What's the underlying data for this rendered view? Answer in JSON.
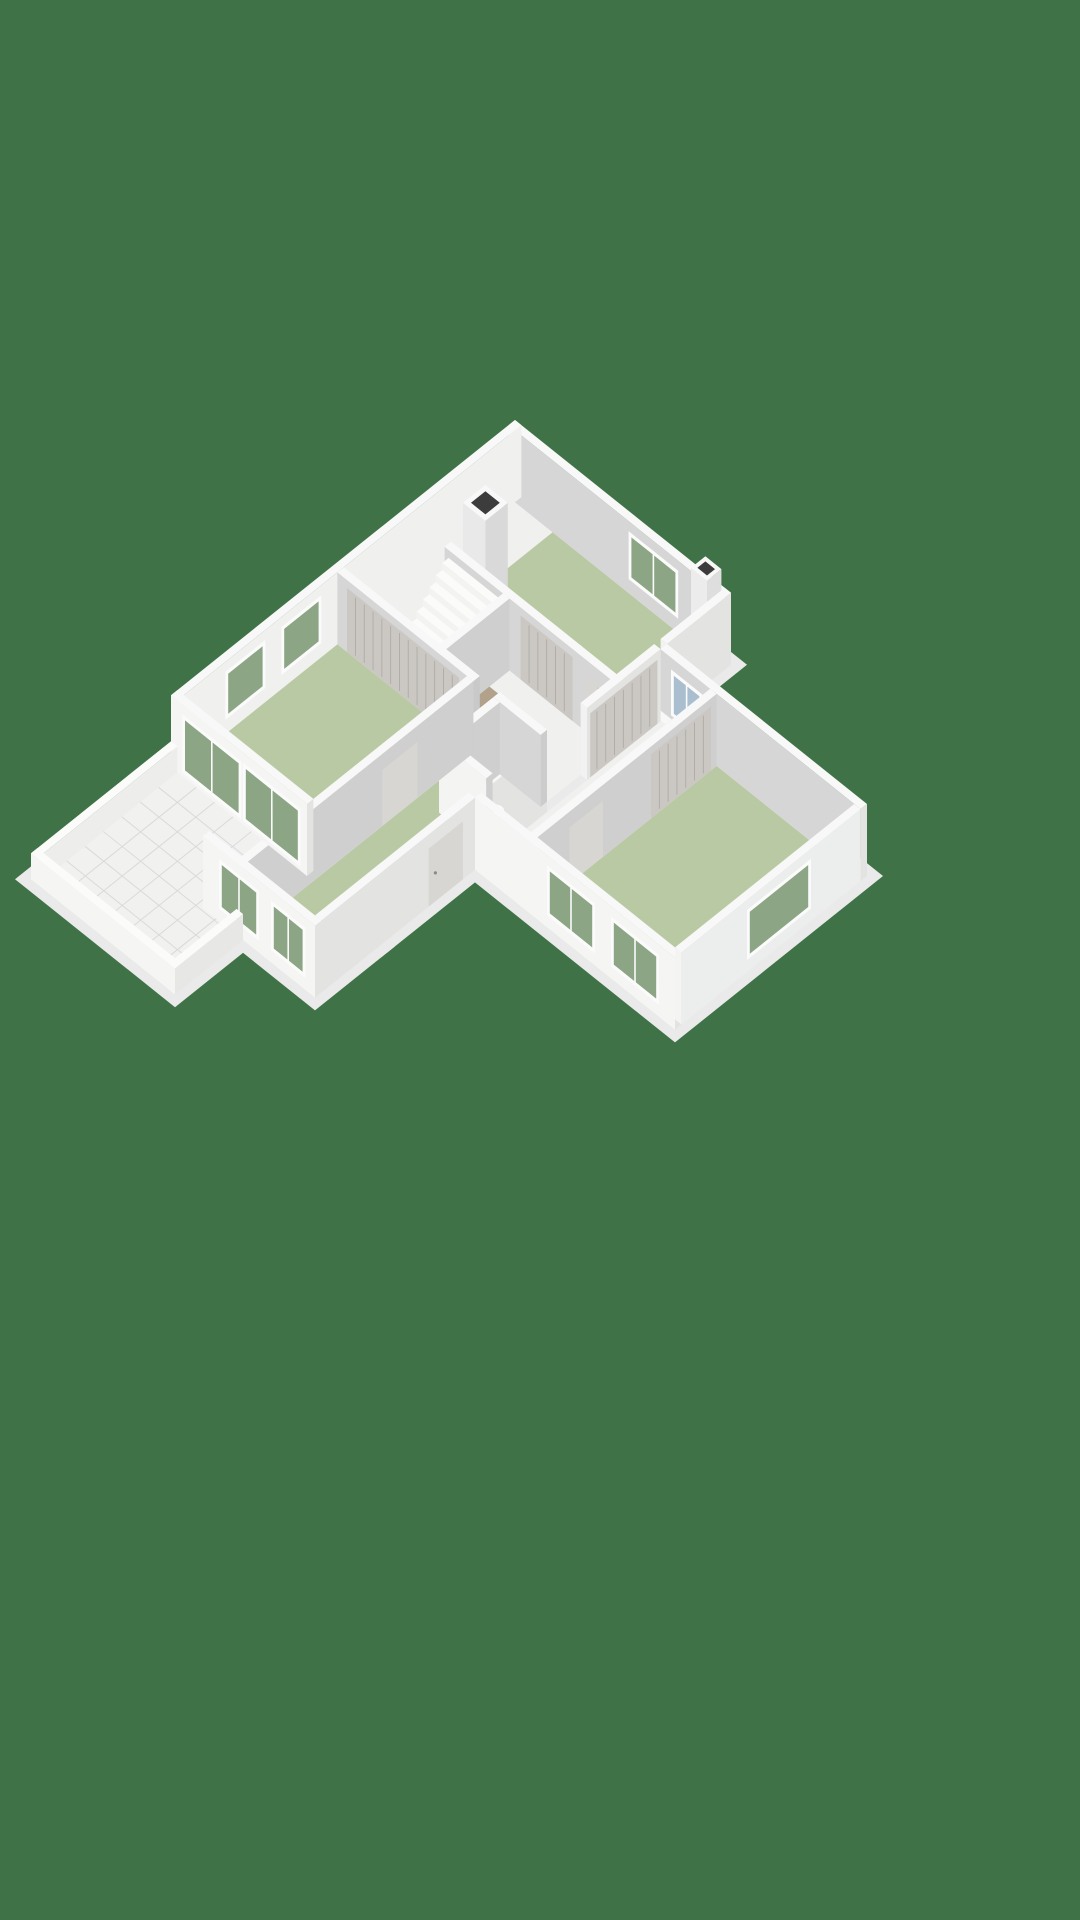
{
  "scene": {
    "type": "isometric-3d-floorplan-render",
    "floor_level": "ground-floor",
    "view": "dollhouse-cutaway",
    "visible_text": ""
  },
  "colors": {
    "background": "#3f7246",
    "slab": "#e9eae9",
    "wall_top": "#f8f8f8",
    "wall_bright": "#f5f5f4",
    "wall_gray": "#d6d6d6",
    "wall_medium": "#e3e3e2",
    "wall_inner": "#cfcfcf",
    "floor_white": "#f0f0ef",
    "floor_green": "#b9c9a3",
    "floor_tan": "#b3a28b",
    "floor_bath": "#ccd4da",
    "tile": "#f1f1f0",
    "tile_grid": "#d9dad9",
    "closet": "#cbc8c4",
    "closet_groove": "#aeaba7",
    "door_panel": "#d8d6d3",
    "door_line": "#b7b4b0",
    "glass_green": "#8ca584",
    "glass_blue": "#a9bfd0",
    "shower_glass": "#cfdde6",
    "drain_dark": "#474747",
    "chimney_hole": "#3c3c3c"
  },
  "rooms": [
    {
      "name": "top-bedroom",
      "floor": "floor_green"
    },
    {
      "name": "living-room",
      "floor": "floor_green"
    },
    {
      "name": "middle-room",
      "floor": "floor_green"
    },
    {
      "name": "east-bedroom",
      "floor": "floor_green"
    },
    {
      "name": "hallway",
      "floor": "floor_white"
    },
    {
      "name": "entry-hall",
      "floor": "floor_tan"
    },
    {
      "name": "bathroom",
      "floor": "floor_bath"
    },
    {
      "name": "wc",
      "floor": "floor_white"
    },
    {
      "name": "wing-corridor",
      "floor": "floor_white"
    },
    {
      "name": "terrace",
      "floor": "tile"
    }
  ],
  "features": [
    {
      "name": "staircase",
      "steps": 9
    },
    {
      "name": "chimney"
    },
    {
      "name": "roof-vent"
    },
    {
      "name": "shower",
      "drain": true
    },
    {
      "name": "toilet"
    },
    {
      "name": "wardrobe-closets"
    },
    {
      "name": "glass-doors-to-terrace",
      "panes": 4
    },
    {
      "name": "windows",
      "count": 9
    },
    {
      "name": "terrace-tiles",
      "grid": true
    }
  ]
}
